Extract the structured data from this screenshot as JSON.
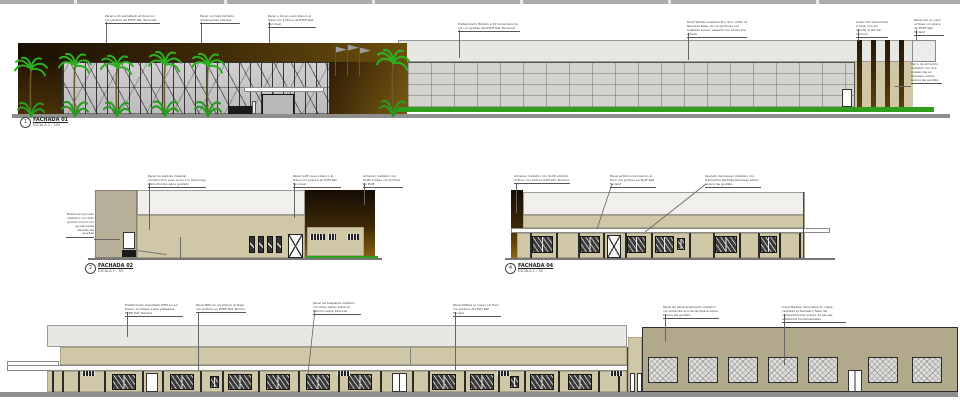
{
  "facades": {
    "f1": {
      "number": "1",
      "title": "FACHADA 01",
      "scale": "ESCALA 1 : 100"
    },
    "f2": {
      "number": "2",
      "title": "FACHADA 02",
      "scale": "ESCALA 1 : 50"
    },
    "f4": {
      "number": "4",
      "title": "FACHADA 04",
      "scale": "ESCALA 1 : 50"
    }
  },
  "notes": {
    "row1": [
      "Panel a 24 esmaltado al Duracon con pintura de PVDF Ref. Tecnoval",
      "Panel con tela fachada dimensiones vidriera",
      "Panel a 24 en vano blanco al Daso con pintura de PVDF Ref. Tecnoval",
      "Prefabricado Modelo a 24 tonos blancos sol con grietas del PVDF Ref. Tecnoval",
      "Road Wallter Acabado B+/ Son combi al Nacional Base, W con pinturas con acabado suave, veteado con pared pre-colada",
      "Acero C/S estructural a Clein con sol acorde al GO bar Incoloro",
      "Panel a/C en vano al Daso con placa de PVDF Ref. Tecland",
      "Tarco de alimento metalico con dos presencias en Damasco sobre beloce las guidats"
    ],
    "row2_left_side": "Puerta en proceso metalico con friso gullica march con ayude verde delante las puertas",
    "row2_left": [
      "Panel de piedras material construccion para el sol con Damongo sobre fondos Aqua guidado",
      "Panel SolE nuevo blanco al Daso con pintura en PCM Ref. Tecnoval",
      "Almacen metalico con SollD a Daso con pintura en PCM"
    ],
    "row2_right": [
      "Almacen metalico con SollD emitido al fluor con pintura PvM Ref. Tecland",
      "Panel w/OLS lucen blanco al fluor con pintura en PLAF Ref. Tecland",
      "Aparato de plasayo metalico con trascentos partidas Damergo sobre beloce las guidats"
    ],
    "row3": [
      "Prefabricado ensoldado NTM en sol blanco en Dasos sobre plateados PVDE Ref. Tecland",
      "Panel NPQ en sol blanco al Daso con pintura en PVDE Ref. Tecnico",
      "Panel de traspasos metalico con fotos valiso sobre en Dalorco sobre pinturas",
      "Panel M/Nica al nuevo sol fluor con pintura del PVD Ref. Tecnars",
      "Panel de almacenamiento metalico con botavilla acorde las Space sobre beloce las guidats",
      "Copa Madera decorativa Sr. Clase cantidad el Damasco Tassi del compartimiento previo de escolar artefactos fundamentales"
    ]
  },
  "colors": {
    "beige_wall": "#cfc7a6",
    "khaki_wall": "#b2a98c",
    "dark_brown": "#241505",
    "golden_brown": "#7a5a12",
    "palm_green": "#2fae22",
    "hedge_green": "#2f9e1d",
    "glass_gray": "#c8c8c8",
    "block_gray": "#d5d3cd",
    "parapet_gray": "#e7e7e4",
    "ground_gray": "#8e8e8c"
  }
}
